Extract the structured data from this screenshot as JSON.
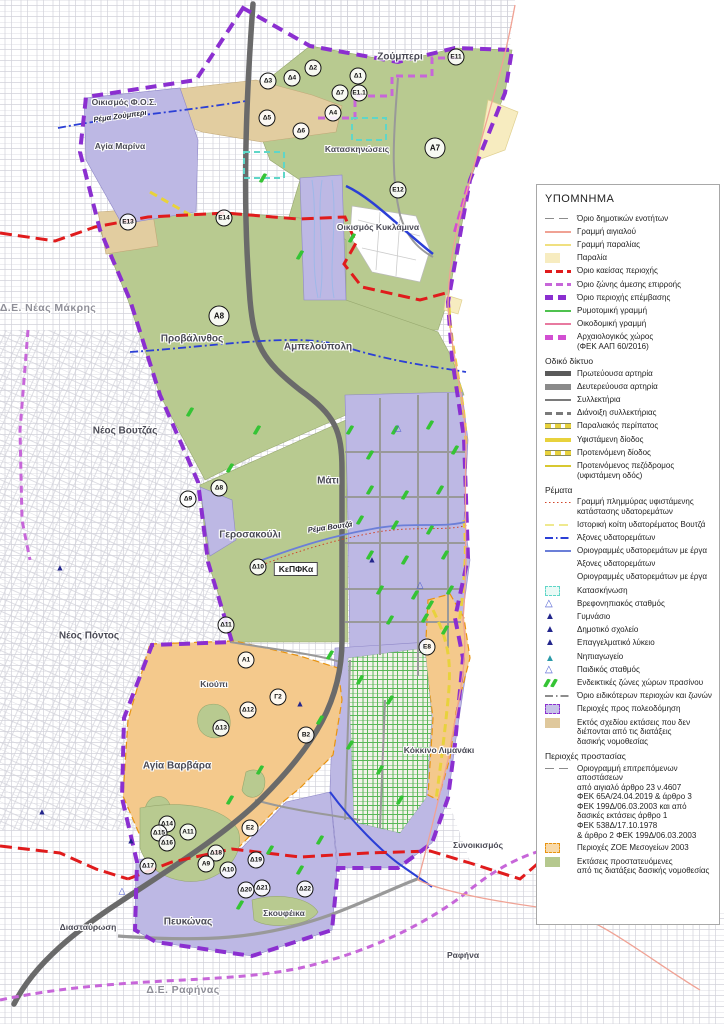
{
  "legend": {
    "title": "ΥΠΟΜΝΗΜΑ",
    "items": [
      {
        "sym": "dash-long",
        "color": "#8c8c8c",
        "label": "Όριο δημοτικών ενοτήτων"
      },
      {
        "sym": "line",
        "color": "#f0a294",
        "label": "Γραμμή αιγιαλού"
      },
      {
        "sym": "line",
        "color": "#f0e080",
        "label": "Γραμμή παραλίας"
      },
      {
        "sym": "patch",
        "fill": "#f7ecc0",
        "label": "Παραλία"
      },
      {
        "sym": "dash-bold",
        "color": "#e01b1c",
        "label": "Όριο καείσας περιοχής"
      },
      {
        "sym": "dash-bold",
        "color": "#c766d9",
        "label": "Όριο ζώνης άμεσης επιρροής"
      },
      {
        "sym": "dash-thick",
        "color": "#8b2fd0",
        "label": "Όριο περιοχής επέμβασης"
      },
      {
        "sym": "line",
        "color": "#4fc24f",
        "label": "Ρυμοτομική γραμμή"
      },
      {
        "sym": "line",
        "color": "#e87aa0",
        "label": "Οικοδομική γραμμή"
      },
      {
        "sym": "dash-thick",
        "color": "#d24fd2",
        "label": "Αρχαιολογικός χώρος\n(ΦΕΚ ΑΑΠ 60/2016)"
      },
      {
        "header": "Οδικό δίκτυο"
      },
      {
        "sym": "bar",
        "color": "#5a5a5a",
        "label": "Πρωτεύουσα αρτηρία"
      },
      {
        "sym": "bar",
        "color": "#8a8a8a",
        "label": "Δευτερεύουσα αρτηρία"
      },
      {
        "sym": "line2",
        "color": "#7a7a7a",
        "label": "Συλλεκτήρια"
      },
      {
        "sym": "dash-bold",
        "color": "#7a7a7a",
        "label": "Διάνοιξη συλλεκτήριας"
      },
      {
        "sym": "dash-outline",
        "color": "#e8d23c",
        "label": "Παραλιακός περίπατος"
      },
      {
        "sym": "line3",
        "color": "#e8d23c",
        "label": "Υφιστάμενη δίοδος"
      },
      {
        "sym": "dash-outline",
        "color": "#e8d23c",
        "label": "Προτεινόμενη δίοδος"
      },
      {
        "sym": "line2",
        "color": "#d8c830",
        "label": "Προτεινόμενος πεζόδρομος\n(υφιστάμενη οδός)"
      },
      {
        "header": "Ρέματα"
      },
      {
        "sym": "dotted",
        "color": "#d0452a",
        "label": "Γραμμή πλημμύρας υφιστάμενης\nκατάστασης υδατορεμάτων"
      },
      {
        "sym": "dash-long",
        "color": "#efe98f",
        "label": "Ιστορική κοίτη υδατορέματος Βουτζά"
      },
      {
        "sym": "dashdot",
        "color": "#2b3fd6",
        "label": "Άξονες υδατορεμάτων"
      },
      {
        "sym": "line",
        "color": "#6b7fd8",
        "label": "Οριογραμμές υδατορεμάτων με έργα"
      },
      {
        "sym": "none",
        "label": "Άξονες υδατορεμάτων"
      },
      {
        "sym": "none",
        "label": "Οριογραμμές υδατορεμάτων με έργα"
      },
      {
        "sym": "patch-dash",
        "fill": "#eafaf6",
        "border": "#5fd6c8",
        "label": "Κατασκήνωση"
      },
      {
        "sym": "tri-open",
        "color": "#4a5ad0",
        "label": "Βρεφονηπιακός σταθμός"
      },
      {
        "sym": "tri-filled",
        "color": "#23268c",
        "label": "Γυμνάσιο"
      },
      {
        "sym": "tri-filled",
        "color": "#23268c",
        "label": "Δημοτικό σχολείο"
      },
      {
        "sym": "tri-filled",
        "color": "#23268c",
        "label": "Επαγγελματικό λύκειο"
      },
      {
        "sym": "tri-lines",
        "color": "#2a9aa8",
        "label": "Νηπιαγωγείο"
      },
      {
        "sym": "tri-open",
        "color": "#4a5ad0",
        "label": "Παιδικός σταθμός"
      },
      {
        "sym": "green-marks",
        "color": "#35c435",
        "label": "Ενδεικτικές ζώνες χώρων πρασίνου"
      },
      {
        "sym": "dashdot",
        "color": "#8c8c8c",
        "label": "Όριο ειδικότερων περιοχών και ζωνών"
      },
      {
        "sym": "patch-dash",
        "fill": "#c6c2e8",
        "border": "#8b2fd0",
        "label": "Περιοχές προς πολεοδόμηση"
      },
      {
        "sym": "patch",
        "fill": "#dfc89c",
        "label": "Εκτός σχεδίου εκτάσεις που δεν\nδιέπονται από τις διατάξεις\nδασικής νομοθεσίας"
      },
      {
        "header": "Περιοχές προστασίας"
      },
      {
        "sym": "dash-long",
        "color": "#8c8c8c",
        "label": "Οριογραμμή επιτρεπόμενων αποστάσεων\nαπό αιγιαλό άρθρο 23 ν.4607\nΦΕΚ 65Α/24.04.2019 & άρθρο 3\nΦΕΚ 199Δ/06.03.2003 και από\nδασικές εκτάσεις άρθρο 1\nΦΕΚ 538Δ/17.10.1978\n& άρθρο 2 ΦΕΚ 199Δ/06.03.2003"
      },
      {
        "sym": "patch-dash",
        "fill": "#f8d9a8",
        "border": "#e8930f",
        "label": "Περιοχές ΖΟΕ Μεσογείων 2003"
      },
      {
        "sym": "patch",
        "fill": "#b5c88e",
        "label": "Εκτάσεις προστατευόμενες\nαπό τις διατάξεις δασικής νομοθεσίας"
      }
    ]
  },
  "map": {
    "labels": [
      {
        "t": "Ζούμπερι",
        "x": 400,
        "y": 57,
        "cls": "area"
      },
      {
        "t": "Οικισμός Φ.Ο.Σ.",
        "x": 124,
        "y": 102,
        "cls": "area-sm"
      },
      {
        "t": "Αγία Μαρίνα",
        "x": 120,
        "y": 146,
        "cls": "area-sm"
      },
      {
        "t": "Κατασκηνώσεις",
        "x": 357,
        "y": 149,
        "cls": "area-sm"
      },
      {
        "t": "Οικισμός Κυκλάμινα",
        "x": 378,
        "y": 227,
        "cls": "area-sm"
      },
      {
        "t": "Δ.Ε. Νέας Μάκρης",
        "x": 48,
        "y": 308,
        "cls": "de"
      },
      {
        "t": "Προβάλινθος",
        "x": 192,
        "y": 339,
        "cls": "area"
      },
      {
        "t": "Αμπελούπολη",
        "x": 318,
        "y": 347,
        "cls": "area"
      },
      {
        "t": "Νέος Βουτζάς",
        "x": 125,
        "y": 431,
        "cls": "area"
      },
      {
        "t": "Μάτι",
        "x": 328,
        "y": 481,
        "cls": "area"
      },
      {
        "t": "Γεροσακούλι",
        "x": 250,
        "y": 535,
        "cls": "area"
      },
      {
        "t": "Ρέμα Βουτζά",
        "x": 330,
        "y": 527,
        "cls": "stream"
      },
      {
        "t": "Ρέμα Ζούμπερι",
        "x": 120,
        "y": 116,
        "cls": "stream"
      },
      {
        "t": "ΚεΠΦΚα",
        "x": 296,
        "y": 569,
        "cls": "box"
      },
      {
        "t": "Νέος Πόντος",
        "x": 89,
        "y": 636,
        "cls": "area"
      },
      {
        "t": "Κιούπι",
        "x": 214,
        "y": 684,
        "cls": "area-sm"
      },
      {
        "t": "Αγία Βαρβάρα",
        "x": 177,
        "y": 766,
        "cls": "area"
      },
      {
        "t": "Κόκκινο Λιμανάκι",
        "x": 439,
        "y": 750,
        "cls": "area-sm"
      },
      {
        "t": "Συνοικισμός",
        "x": 478,
        "y": 845,
        "cls": "area-sm"
      },
      {
        "t": "Πευκώνας",
        "x": 188,
        "y": 922,
        "cls": "area"
      },
      {
        "t": "Σκουφέικα",
        "x": 284,
        "y": 913,
        "cls": "area-sm"
      },
      {
        "t": "Διασταύρωση",
        "x": 88,
        "y": 927,
        "cls": "area-sm"
      },
      {
        "t": "Δ.Ε. Ραφήνας",
        "x": 183,
        "y": 990,
        "cls": "de"
      },
      {
        "t": "Ραφήνα",
        "x": 463,
        "y": 955,
        "cls": "area-sm"
      }
    ],
    "badges": [
      {
        "id": "Δ3",
        "x": 268,
        "y": 81
      },
      {
        "id": "Δ4",
        "x": 292,
        "y": 78
      },
      {
        "id": "Δ2",
        "x": 313,
        "y": 68
      },
      {
        "id": "Δ1",
        "x": 358,
        "y": 76
      },
      {
        "id": "Δ7",
        "x": 340,
        "y": 93
      },
      {
        "id": "Ε1.1",
        "x": 359,
        "y": 93
      },
      {
        "id": "Α4",
        "x": 333,
        "y": 113
      },
      {
        "id": "Δ5",
        "x": 267,
        "y": 118
      },
      {
        "id": "Δ6",
        "x": 301,
        "y": 131
      },
      {
        "id": "Ε11",
        "x": 456,
        "y": 57
      },
      {
        "id": "Α7",
        "x": 435,
        "y": 148,
        "big": true
      },
      {
        "id": "Ε12",
        "x": 398,
        "y": 190
      },
      {
        "id": "Ε13",
        "x": 128,
        "y": 222
      },
      {
        "id": "Ε14",
        "x": 224,
        "y": 218
      },
      {
        "id": "Α8",
        "x": 219,
        "y": 316,
        "big": true
      },
      {
        "id": "Δ8",
        "x": 219,
        "y": 488
      },
      {
        "id": "Δ9",
        "x": 188,
        "y": 499
      },
      {
        "id": "Δ10",
        "x": 258,
        "y": 567
      },
      {
        "id": "Δ11",
        "x": 226,
        "y": 625
      },
      {
        "id": "Α1",
        "x": 246,
        "y": 660
      },
      {
        "id": "Γ2",
        "x": 278,
        "y": 697
      },
      {
        "id": "Δ12",
        "x": 248,
        "y": 710
      },
      {
        "id": "Δ13",
        "x": 221,
        "y": 728
      },
      {
        "id": "Β2",
        "x": 306,
        "y": 735
      },
      {
        "id": "Ε8",
        "x": 427,
        "y": 647
      },
      {
        "id": "Ε2",
        "x": 250,
        "y": 828
      },
      {
        "id": "Δ14",
        "x": 167,
        "y": 824
      },
      {
        "id": "Δ15",
        "x": 159,
        "y": 833
      },
      {
        "id": "Α11",
        "x": 188,
        "y": 832
      },
      {
        "id": "Δ16",
        "x": 167,
        "y": 843
      },
      {
        "id": "Δ17",
        "x": 148,
        "y": 866
      },
      {
        "id": "Δ18",
        "x": 216,
        "y": 853
      },
      {
        "id": "Α9",
        "x": 206,
        "y": 864
      },
      {
        "id": "Α10",
        "x": 228,
        "y": 870
      },
      {
        "id": "Δ19",
        "x": 256,
        "y": 860
      },
      {
        "id": "Δ20",
        "x": 246,
        "y": 890
      },
      {
        "id": "Δ21",
        "x": 262,
        "y": 888
      },
      {
        "id": "Δ22",
        "x": 305,
        "y": 889
      }
    ],
    "green_marks": [
      [
        263,
        178
      ],
      [
        352,
        238
      ],
      [
        300,
        255
      ],
      [
        190,
        412
      ],
      [
        230,
        468
      ],
      [
        257,
        430
      ],
      [
        350,
        430
      ],
      [
        370,
        455
      ],
      [
        395,
        430
      ],
      [
        430,
        425
      ],
      [
        455,
        450
      ],
      [
        370,
        490
      ],
      [
        405,
        495
      ],
      [
        440,
        490
      ],
      [
        360,
        520
      ],
      [
        395,
        525
      ],
      [
        430,
        530
      ],
      [
        370,
        555
      ],
      [
        405,
        560
      ],
      [
        445,
        555
      ],
      [
        380,
        590
      ],
      [
        415,
        595
      ],
      [
        450,
        590
      ],
      [
        390,
        620
      ],
      [
        425,
        618
      ],
      [
        330,
        655
      ],
      [
        360,
        680
      ],
      [
        390,
        700
      ],
      [
        320,
        720
      ],
      [
        350,
        745
      ],
      [
        380,
        770
      ],
      [
        400,
        800
      ],
      [
        260,
        770
      ],
      [
        230,
        800
      ],
      [
        320,
        840
      ],
      [
        270,
        850
      ],
      [
        240,
        905
      ],
      [
        300,
        870
      ],
      [
        430,
        605
      ],
      [
        445,
        630
      ]
    ],
    "schools": [
      {
        "x": 60,
        "y": 568,
        "t": "f"
      },
      {
        "x": 42,
        "y": 812,
        "t": "f"
      },
      {
        "x": 131,
        "y": 841,
        "t": "f"
      },
      {
        "x": 122,
        "y": 891,
        "t": "o"
      },
      {
        "x": 398,
        "y": 428,
        "t": "o"
      },
      {
        "x": 372,
        "y": 560,
        "t": "f"
      },
      {
        "x": 420,
        "y": 585,
        "t": "o"
      },
      {
        "x": 300,
        "y": 704,
        "t": "f"
      }
    ]
  },
  "colors": {
    "zone_residential": "#bdb8e4",
    "zone_forest": "#b8ca90",
    "zone_zoe": "#f4c98c",
    "zone_outofplan": "#e2cda0",
    "beach": "#f7ecc0",
    "boundary_intervention": "#8b2fd0",
    "boundary_influence": "#c766d9",
    "burnt_line": "#e01b1c",
    "archaeological": "#d24fd2",
    "road_primary": "#6a6a6a",
    "road_secondary": "#999999",
    "stream": "#2b3fd6",
    "stream_works": "#6b7fd8",
    "flood": "#d0452a",
    "yellow_path": "#e8d23c",
    "grid": "#d2d2da",
    "school": "#23268c",
    "school_open": "#4a5ad0",
    "greenmark": "#35c435",
    "camp": "#5fd6c8",
    "shoreline": "#f0a294",
    "greengrid": "#3fae3f"
  }
}
